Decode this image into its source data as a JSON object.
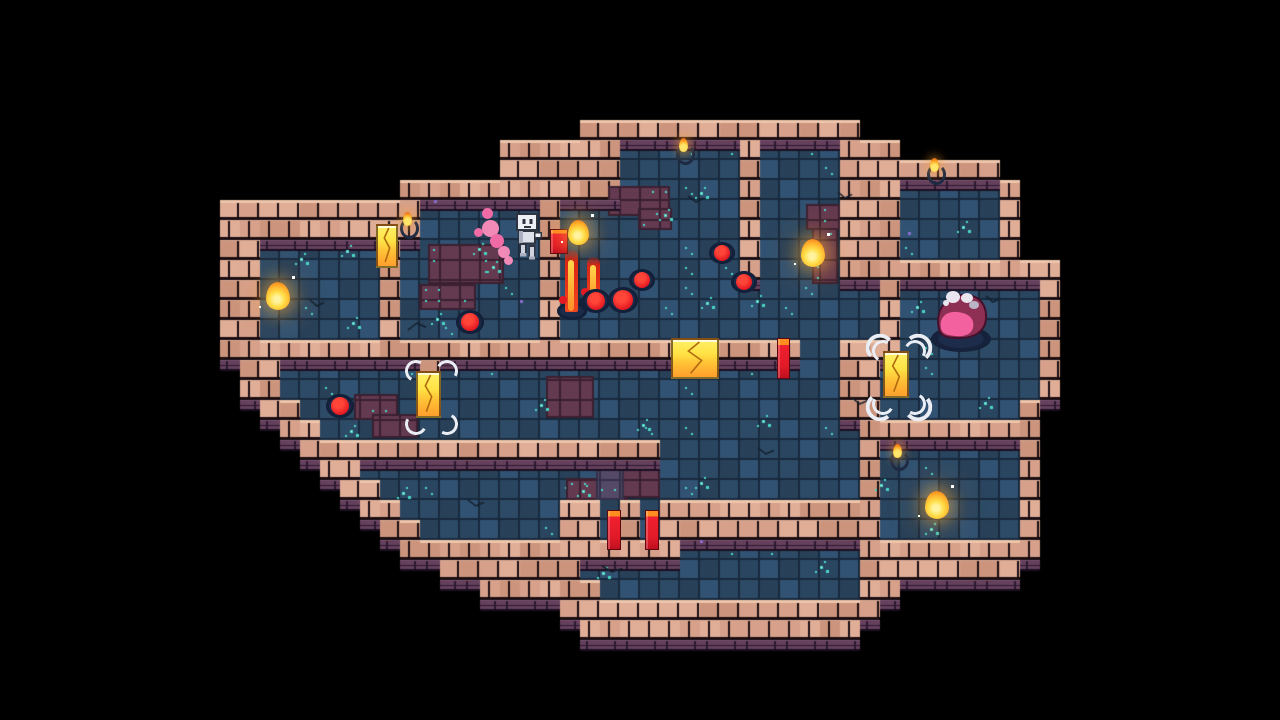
{
  "scene": {
    "name": "dungeon-map-room",
    "width": 1280,
    "height": 720,
    "tile": 20,
    "palette": {
      "void": "#000000",
      "brick": [
        "#d6a08a",
        "#e0ad97",
        "#cc947c"
      ],
      "brick_top": "#eec6ab",
      "brick_seam": "#e0b09a",
      "brick_gap": "#1a0d11",
      "face": "#64405c",
      "face_hi": "#7a5574",
      "face_gap": "#2c1832",
      "face_edge": "#1b0e21",
      "floor": [
        "#2d4b66",
        "#2a4560",
        "#315272",
        "#284159"
      ],
      "floor_grid": "#17293d",
      "maroon": "#643a50",
      "maroon_grid": "#3a2030",
      "purple": "#544a68",
      "purple_grid": "#343048",
      "sparkle": "#49d8c5",
      "sparkle_core": "#d8fff2",
      "dot_purple": "#8a6fd0",
      "crack": "#121f2c",
      "flame_core": "#ffdf4a",
      "flame_mid": "#ffb02a",
      "flame_edge": "#f07d1c",
      "block_yellow": "#ffe244",
      "block_orange": "#ff9e2c",
      "door_red": "#e81a28",
      "door_orange": "#ff8d1f",
      "hero_body": "#eceff4",
      "hero_shade": "#aab0c0",
      "hero_line": "#2e3440",
      "trail_pink": "#f28ab8",
      "trail_pink2": "#ee6ba6",
      "boss_dark": "#8e3054",
      "boss_pink": "#f4619f",
      "boss_white": "#eae6f0",
      "boss_gray": "#b9b5c6",
      "pad_navy": "#16223c"
    },
    "grid": [
      "................................................................",
      "................................................................",
      "................................................................",
      "................................................................",
      "................................................................",
      "................................................................",
      ".............................##############.....................",
      ".........................######ffffff#ffff###...................",
      ".........................######ffffff#ffff########..............",
      "....................###########ffffff#ffff###fffff#.............",
      "...........##########ffffff#fffffffff#ffff###fffff#.............",
      "...........##########ffffff#fffffffff#ffff###fffff#.............",
      "...........##ffffff#fffffff#fffffffff#ffff###fffff#.............",
      "...........##ffffff#fffffff#fffffffff#ffff###########...........",
      "...........##ffffff#fffffff#ffffffffffffffff#fffffff#...........",
      "...........##ffffff#fffffff#ffffffffffffffff#fffffff#...........",
      "...........##ffffff#fffffff#ffffffffffffffff#fffffff#...........",
      "...........#############################ff###fffffff#...........",
      "............##fffffff#ffffffffffffffffffff##ffffffff#...........",
      "............##fffffff#ffffffffffffffffffff##ffffffff#...........",
      ".............##fffffffffffffffffffffffffff##fffffff#............",
      "..............##fffffffffffffffffffffffffff#########............",
      "...............##################ffffffffff#fffffff#............",
      "................##fffffffffffffffffffffffff#fffffff#............",
      ".................##ffffffffffffffffffffffff#fffffff#............",
      "..................##ffffffff##f#f###########fffffff#............",
      "...................##fffffff##f#f###########fffffff#............",
      "....................##############fffffffff#########............",
      "......................#######ffffffffffffff########.............",
      "........................######fffffffffffff##...................",
      "............................################....................",
      ".............................##############.....................",
      "................................................................",
      "................................................................",
      "................................................................",
      "................................................................"
    ],
    "entities": {
      "player": {
        "name": "robot-hero",
        "x": 510,
        "y": 212,
        "w": 34,
        "h": 52,
        "trail": [
          [
            -28,
            8,
            17
          ],
          [
            -20,
            22,
            14
          ],
          [
            -12,
            34,
            12
          ],
          [
            -28,
            -4,
            11
          ],
          [
            -6,
            44,
            9
          ],
          [
            -36,
            16,
            9
          ]
        ]
      },
      "boss": {
        "name": "pink-slime-boss",
        "x": 928,
        "y": 284,
        "w": 66,
        "h": 70
      },
      "torches": [
        {
          "x": 407,
          "y": 210
        },
        {
          "x": 683,
          "y": 136
        },
        {
          "x": 934,
          "y": 156
        },
        {
          "x": 897,
          "y": 442
        }
      ],
      "flames": [
        {
          "x": 278,
          "y": 294,
          "s": 24
        },
        {
          "x": 578,
          "y": 230,
          "s": 21
        },
        {
          "x": 813,
          "y": 251,
          "s": 24
        },
        {
          "x": 937,
          "y": 503,
          "s": 24
        }
      ],
      "blocks": [
        {
          "x": 376,
          "y": 224,
          "w": 22,
          "h": 44,
          "brackets": 0
        },
        {
          "x": 416,
          "y": 371,
          "w": 25,
          "h": 47,
          "brackets": 1
        },
        {
          "x": 883,
          "y": 351,
          "w": 26,
          "h": 47,
          "brackets": 2
        },
        {
          "x": 671,
          "y": 338,
          "w": 48,
          "h": 41,
          "brackets": 0
        }
      ],
      "doors": [
        {
          "x": 550,
          "y": 229,
          "w": 16,
          "h": 23
        },
        {
          "x": 777,
          "y": 338,
          "w": 11,
          "h": 39
        },
        {
          "x": 607,
          "y": 510,
          "w": 12,
          "h": 38
        },
        {
          "x": 645,
          "y": 510,
          "w": 12,
          "h": 38
        }
      ],
      "jets": [
        {
          "x": 571,
          "y": 250,
          "h": 62
        },
        {
          "x": 593,
          "y": 257,
          "h": 47
        }
      ],
      "blobs": [
        {
          "x": 596,
          "y": 301,
          "r": 9
        },
        {
          "x": 623,
          "y": 300,
          "r": 10
        },
        {
          "x": 642,
          "y": 280,
          "r": 8
        },
        {
          "x": 470,
          "y": 322,
          "r": 9
        },
        {
          "x": 340,
          "y": 406,
          "r": 9
        },
        {
          "x": 722,
          "y": 253,
          "r": 8
        },
        {
          "x": 744,
          "y": 282,
          "r": 8
        }
      ]
    },
    "decor": {
      "patches": [
        {
          "x": 428,
          "y": 244,
          "w": 76,
          "h": 40,
          "t": "m"
        },
        {
          "x": 420,
          "y": 284,
          "w": 56,
          "h": 26,
          "t": "m"
        },
        {
          "x": 608,
          "y": 186,
          "w": 62,
          "h": 30,
          "t": "m"
        },
        {
          "x": 638,
          "y": 208,
          "w": 34,
          "h": 22,
          "t": "m"
        },
        {
          "x": 806,
          "y": 204,
          "w": 34,
          "h": 26,
          "t": "m"
        },
        {
          "x": 812,
          "y": 228,
          "w": 26,
          "h": 56,
          "t": "m"
        },
        {
          "x": 354,
          "y": 394,
          "w": 44,
          "h": 26,
          "t": "m"
        },
        {
          "x": 372,
          "y": 414,
          "w": 46,
          "h": 24,
          "t": "m"
        },
        {
          "x": 546,
          "y": 376,
          "w": 48,
          "h": 42,
          "t": "m"
        },
        {
          "x": 566,
          "y": 478,
          "w": 62,
          "h": 22,
          "t": "m"
        },
        {
          "x": 620,
          "y": 468,
          "w": 40,
          "h": 30,
          "t": "m"
        },
        {
          "x": 596,
          "y": 462,
          "w": 28,
          "h": 38,
          "t": "p"
        }
      ],
      "sparkles": [
        [
          300,
          258
        ],
        [
          346,
          250
        ],
        [
          352,
          322
        ],
        [
          436,
          318
        ],
        [
          492,
          266
        ],
        [
          700,
          192
        ],
        [
          664,
          214
        ],
        [
          820,
          566
        ],
        [
          930,
          528
        ],
        [
          700,
          482
        ],
        [
          582,
          490
        ],
        [
          642,
          424
        ],
        [
          762,
          420
        ],
        [
          602,
          572
        ],
        [
          984,
          402
        ],
        [
          402,
          492
        ],
        [
          880,
          484
        ],
        [
          706,
          302
        ],
        [
          478,
          248
        ],
        [
          756,
          300
        ],
        [
          962,
          226
        ],
        [
          916,
          306
        ],
        [
          350,
          430
        ],
        [
          540,
          404
        ]
      ],
      "purple_dots": [
        [
          434,
          200
        ],
        [
          908,
          232
        ],
        [
          700,
          540
        ],
        [
          520,
          300
        ]
      ],
      "cracks": [
        [
          408,
          330,
          18,
          -7
        ],
        [
          688,
          196,
          16,
          6
        ],
        [
          602,
          566,
          20,
          6
        ],
        [
          852,
          398,
          16,
          6
        ],
        [
          986,
          296,
          14,
          6
        ],
        [
          468,
          500,
          16,
          6
        ],
        [
          310,
          300,
          14,
          6
        ],
        [
          758,
          448,
          16,
          6
        ],
        [
          838,
          192,
          14,
          6
        ]
      ]
    }
  }
}
